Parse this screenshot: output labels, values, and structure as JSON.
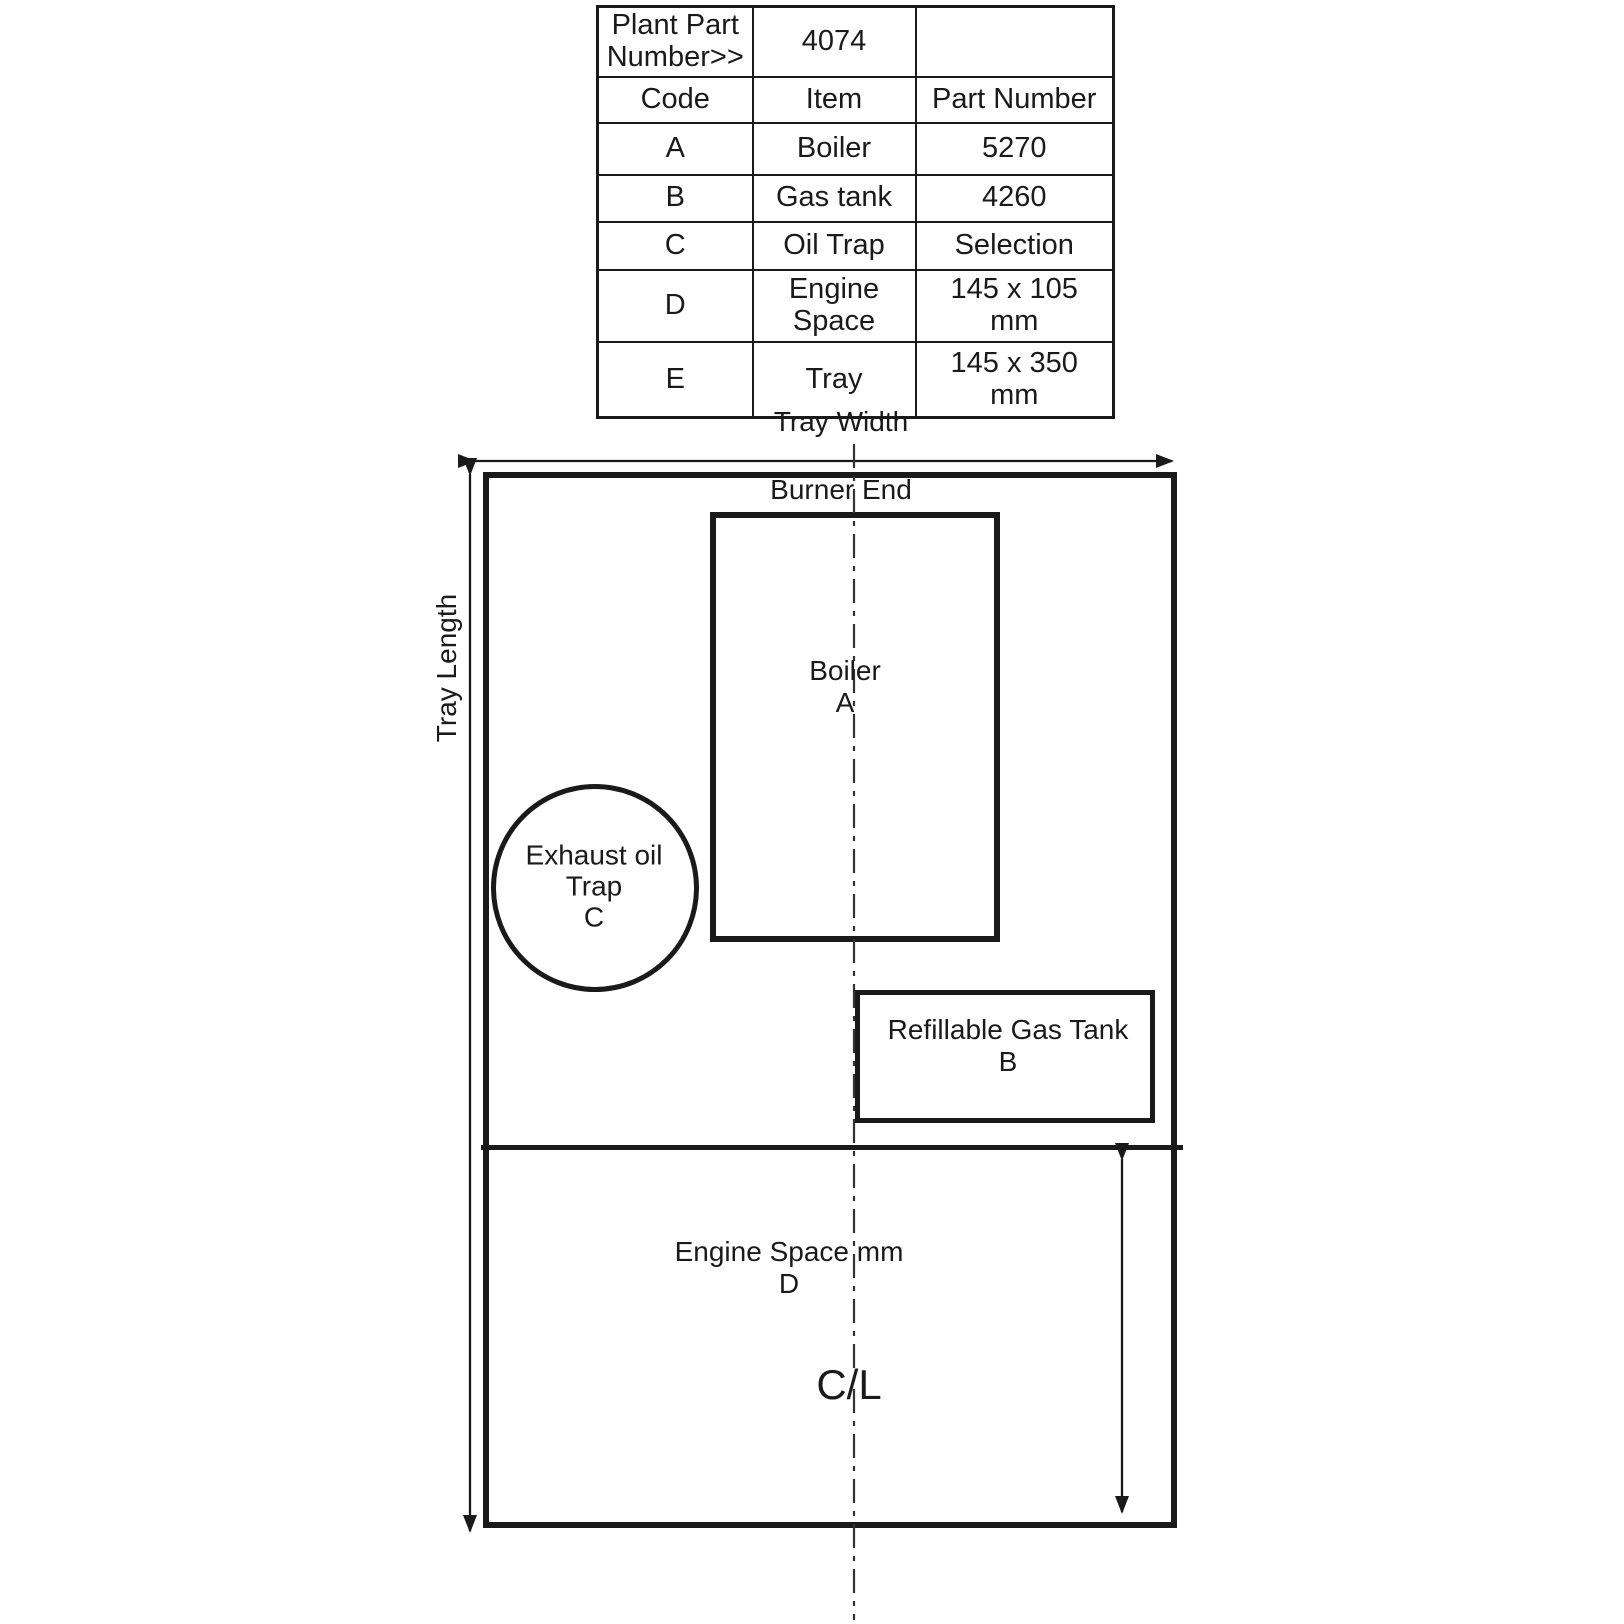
{
  "colors": {
    "ink": "#1a1a1a",
    "paper": "#ffffff"
  },
  "parts_table": {
    "plant_part": {
      "label": "Plant Part Number>>",
      "value": "4074",
      "extra": ""
    },
    "columns": [
      "Code",
      "Item",
      "Part Number"
    ],
    "rows": [
      {
        "code": "A",
        "item": "Boiler",
        "part": "5270"
      },
      {
        "code": "B",
        "item": "Gas tank",
        "part": "4260"
      },
      {
        "code": "C",
        "item": "Oil Trap",
        "part": "Selection"
      },
      {
        "code": "D",
        "item": "Engine Space",
        "part": "145 x 105 mm"
      },
      {
        "code": "E",
        "item": "Tray",
        "part": "145 x 350 mm"
      }
    ]
  },
  "diagram": {
    "tray_width_label": "Tray Width",
    "tray_length_label": "Tray Length",
    "burner_end_label": "Burner End",
    "boiler_label": {
      "line1": "Boiler",
      "line2": "A"
    },
    "oil_trap_label": {
      "line1": "Exhaust oil",
      "line2": "Trap",
      "line3": "C"
    },
    "gas_tank_label": {
      "line1": "Refillable Gas Tank",
      "line2": "B"
    },
    "engine_space_label": {
      "line1": "Engine Space mm",
      "line2": "D"
    },
    "centerline_label": "C/L"
  }
}
